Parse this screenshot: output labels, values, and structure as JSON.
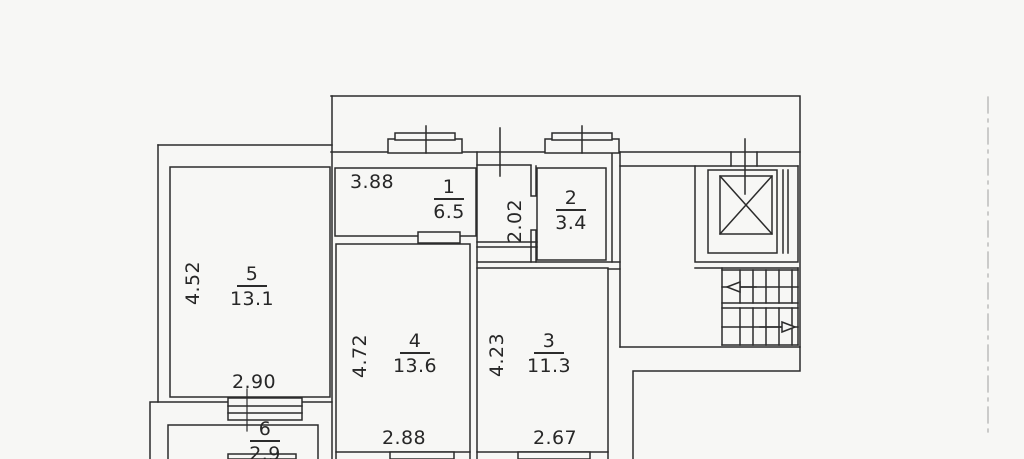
{
  "plan": {
    "type": "apartment-floor-plan",
    "background_color": "#f7f7f5",
    "line_color": "#2c2c2c",
    "rooms": [
      {
        "number": "1",
        "area": "6.5"
      },
      {
        "number": "2",
        "area": "3.4"
      },
      {
        "number": "3",
        "area": "11.3"
      },
      {
        "number": "4",
        "area": "13.6"
      },
      {
        "number": "5",
        "area": "13.1"
      },
      {
        "number": "6",
        "area": "2.9"
      }
    ],
    "dimensions": {
      "room1_width": "3.88",
      "hall_height": "2.02",
      "room2_label_context": "3.4",
      "room5_height": "4.52",
      "room5_width": "2.90",
      "room4_height": "4.72",
      "room4_width": "2.88",
      "room3_height": "4.23",
      "room3_width": "2.67"
    }
  }
}
